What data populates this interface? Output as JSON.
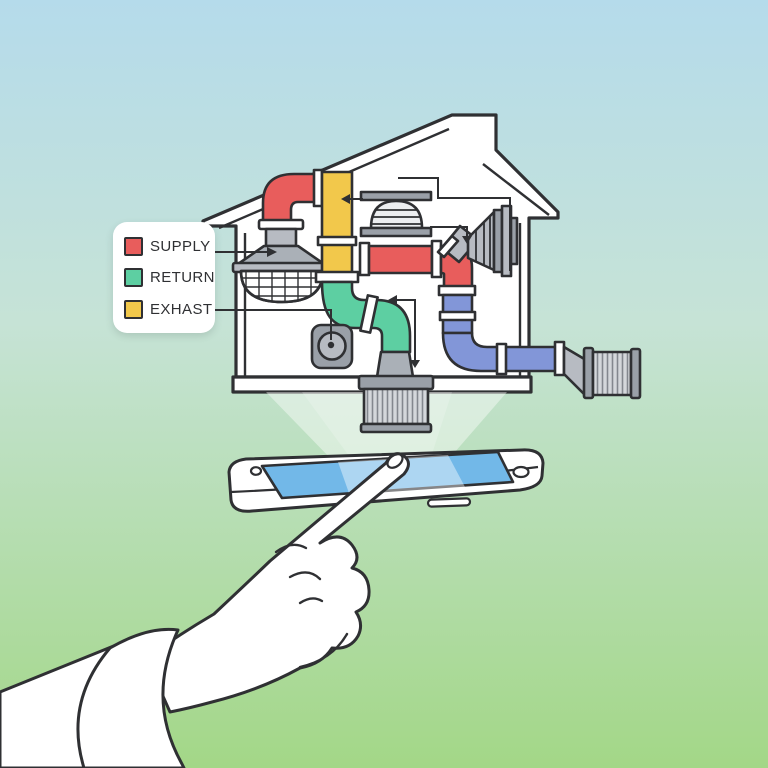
{
  "legend": {
    "items": [
      {
        "id": "supply",
        "label": "SUPPLY",
        "color": "#e85d5c"
      },
      {
        "id": "return",
        "label": "RETURN",
        "color": "#5dcfa2"
      },
      {
        "id": "exhaust",
        "label": "EXHAST",
        "color": "#f2c84b"
      }
    ]
  },
  "palette": {
    "outline": "#2f3033",
    "house_fill": "#ffffff",
    "duct_supply": "#e85d5c",
    "duct_return": "#5dcfa2",
    "duct_exhaust": "#f2c84b",
    "duct_outdoor": "#8296d8",
    "metal": "#b7bbc2",
    "metal_mid": "#aab0b7",
    "metal_dark": "#9aa0a8",
    "filter_ribbed": "#d4d7db",
    "phone_screen": "#72b8e8",
    "beam": "#ffffff",
    "bg_top": "#b5dbeb",
    "bg_bottom": "#a3d787"
  },
  "icons": [
    "house-outline",
    "chimney",
    "supply-duct",
    "exhaust-duct",
    "return-duct",
    "outdoor-duct",
    "bell-diffuser-vent",
    "ceiling-diffuser-vent",
    "cone-vent",
    "exhaust-fan-box",
    "air-filter-unit",
    "outdoor-vent",
    "projection-beam",
    "smartphone",
    "pointing-hand"
  ]
}
